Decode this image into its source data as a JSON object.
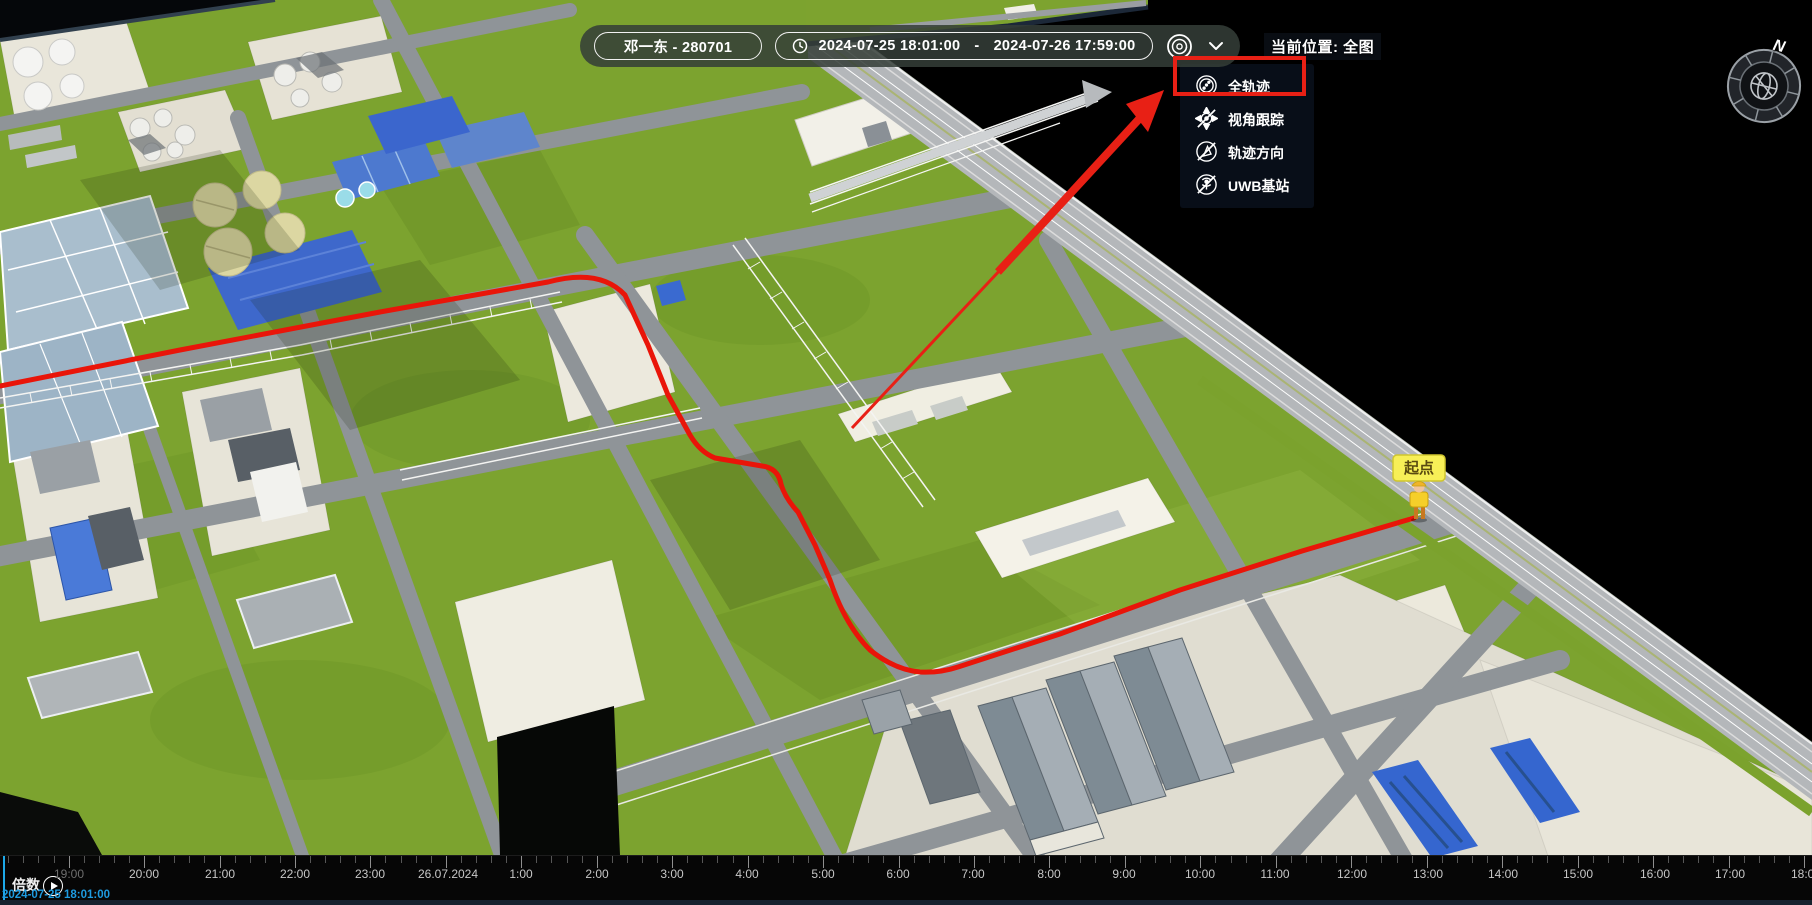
{
  "toolbar": {
    "person": "邓一东 - 280701",
    "date_start": "2024-07-25 18:01:00",
    "date_separator": "-",
    "date_end": "2024-07-26 17:59:00",
    "current_location_label": "当前位置: 全图"
  },
  "dropdown": {
    "items": [
      {
        "label": "全轨迹",
        "icon": "full-trajectory-icon",
        "highlighted": true,
        "disabled": false
      },
      {
        "label": "视角跟踪",
        "icon": "view-tracking-icon",
        "highlighted": false,
        "disabled": true
      },
      {
        "label": "轨迹方向",
        "icon": "trajectory-direction-icon",
        "highlighted": false,
        "disabled": true
      },
      {
        "label": "UWB基站",
        "icon": "uwb-station-icon",
        "highlighted": false,
        "disabled": true
      }
    ]
  },
  "map": {
    "start_marker_label": "起点",
    "compass_label": "N",
    "trajectory_color": "#e91509",
    "annotation_color": "#e82015"
  },
  "timeline": {
    "multiplier_label": "倍数",
    "current_time": "2024-07-25 18:01:00",
    "playhead_x": 3,
    "hour_px": 75.45,
    "origin_x": -6.85,
    "labels": [
      {
        "text": "19:00",
        "x": 69,
        "dim": true
      },
      {
        "text": "20:00",
        "x": 144,
        "dim": false
      },
      {
        "text": "21:00",
        "x": 220,
        "dim": false
      },
      {
        "text": "22:00",
        "x": 295,
        "dim": false
      },
      {
        "text": "23:00",
        "x": 370,
        "dim": false
      },
      {
        "text": "26.07.2024",
        "x": 448,
        "dim": false
      },
      {
        "text": "1:00",
        "x": 521,
        "dim": false
      },
      {
        "text": "2:00",
        "x": 597,
        "dim": false
      },
      {
        "text": "3:00",
        "x": 672,
        "dim": false
      },
      {
        "text": "4:00",
        "x": 747,
        "dim": false
      },
      {
        "text": "5:00",
        "x": 823,
        "dim": false
      },
      {
        "text": "6:00",
        "x": 898,
        "dim": false
      },
      {
        "text": "7:00",
        "x": 973,
        "dim": false
      },
      {
        "text": "8:00",
        "x": 1049,
        "dim": false
      },
      {
        "text": "9:00",
        "x": 1124,
        "dim": false
      },
      {
        "text": "10:00",
        "x": 1200,
        "dim": false
      },
      {
        "text": "11:00",
        "x": 1275,
        "dim": false
      },
      {
        "text": "12:00",
        "x": 1352,
        "dim": false
      },
      {
        "text": "13:00",
        "x": 1428,
        "dim": false
      },
      {
        "text": "14:00",
        "x": 1503,
        "dim": false
      },
      {
        "text": "15:00",
        "x": 1578,
        "dim": false
      },
      {
        "text": "16:00",
        "x": 1655,
        "dim": false
      },
      {
        "text": "17:00",
        "x": 1730,
        "dim": false
      },
      {
        "text": "18:00",
        "x": 1806,
        "dim": false
      }
    ]
  },
  "colors": {
    "grass": "#7ca32f",
    "road": "#8f9498",
    "edge_road": "#b4b7ba",
    "void": "#000000",
    "pale_pad": "#e9e6da",
    "blue_roof": "#3e68cb",
    "basin": "#a9becd",
    "clarifier": "#dcd7a2",
    "marker_yellow": "#f7ef57",
    "playhead_blue": "#1da8e8"
  }
}
